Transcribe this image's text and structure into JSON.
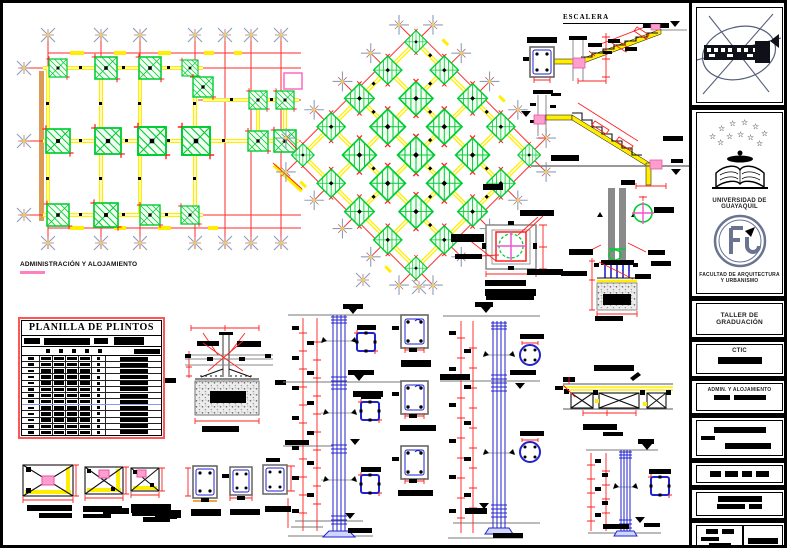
{
  "labels": {
    "stairs_title": "ESCALERA",
    "admin_plan": "ADMINISTRACIÓN Y ALOJAMIENTO"
  },
  "table": {
    "title": "PLANILLA DE PLINTOS",
    "rows": 13,
    "bar_columns": 4
  },
  "sidebar": {
    "university": "UNIVERSIDAD DE GUAYAQUIL",
    "faculty": "FACULTAD DE ARQUITECTURA Y URBANISMO",
    "workshop": "TALLER DE GRADUACIÓN",
    "code": "CTIC",
    "project": "ADMIN. Y ALOJAMIENTO"
  },
  "colors": {
    "grid_red": "#ff2a2a",
    "column_green": "#00cc33",
    "beam_yellow": "#ffee00",
    "rebar_blue": "#2222cc",
    "accent_magenta": "#ee55cc",
    "band_orange": "#dd9a55",
    "border_red": "#ff5555"
  }
}
